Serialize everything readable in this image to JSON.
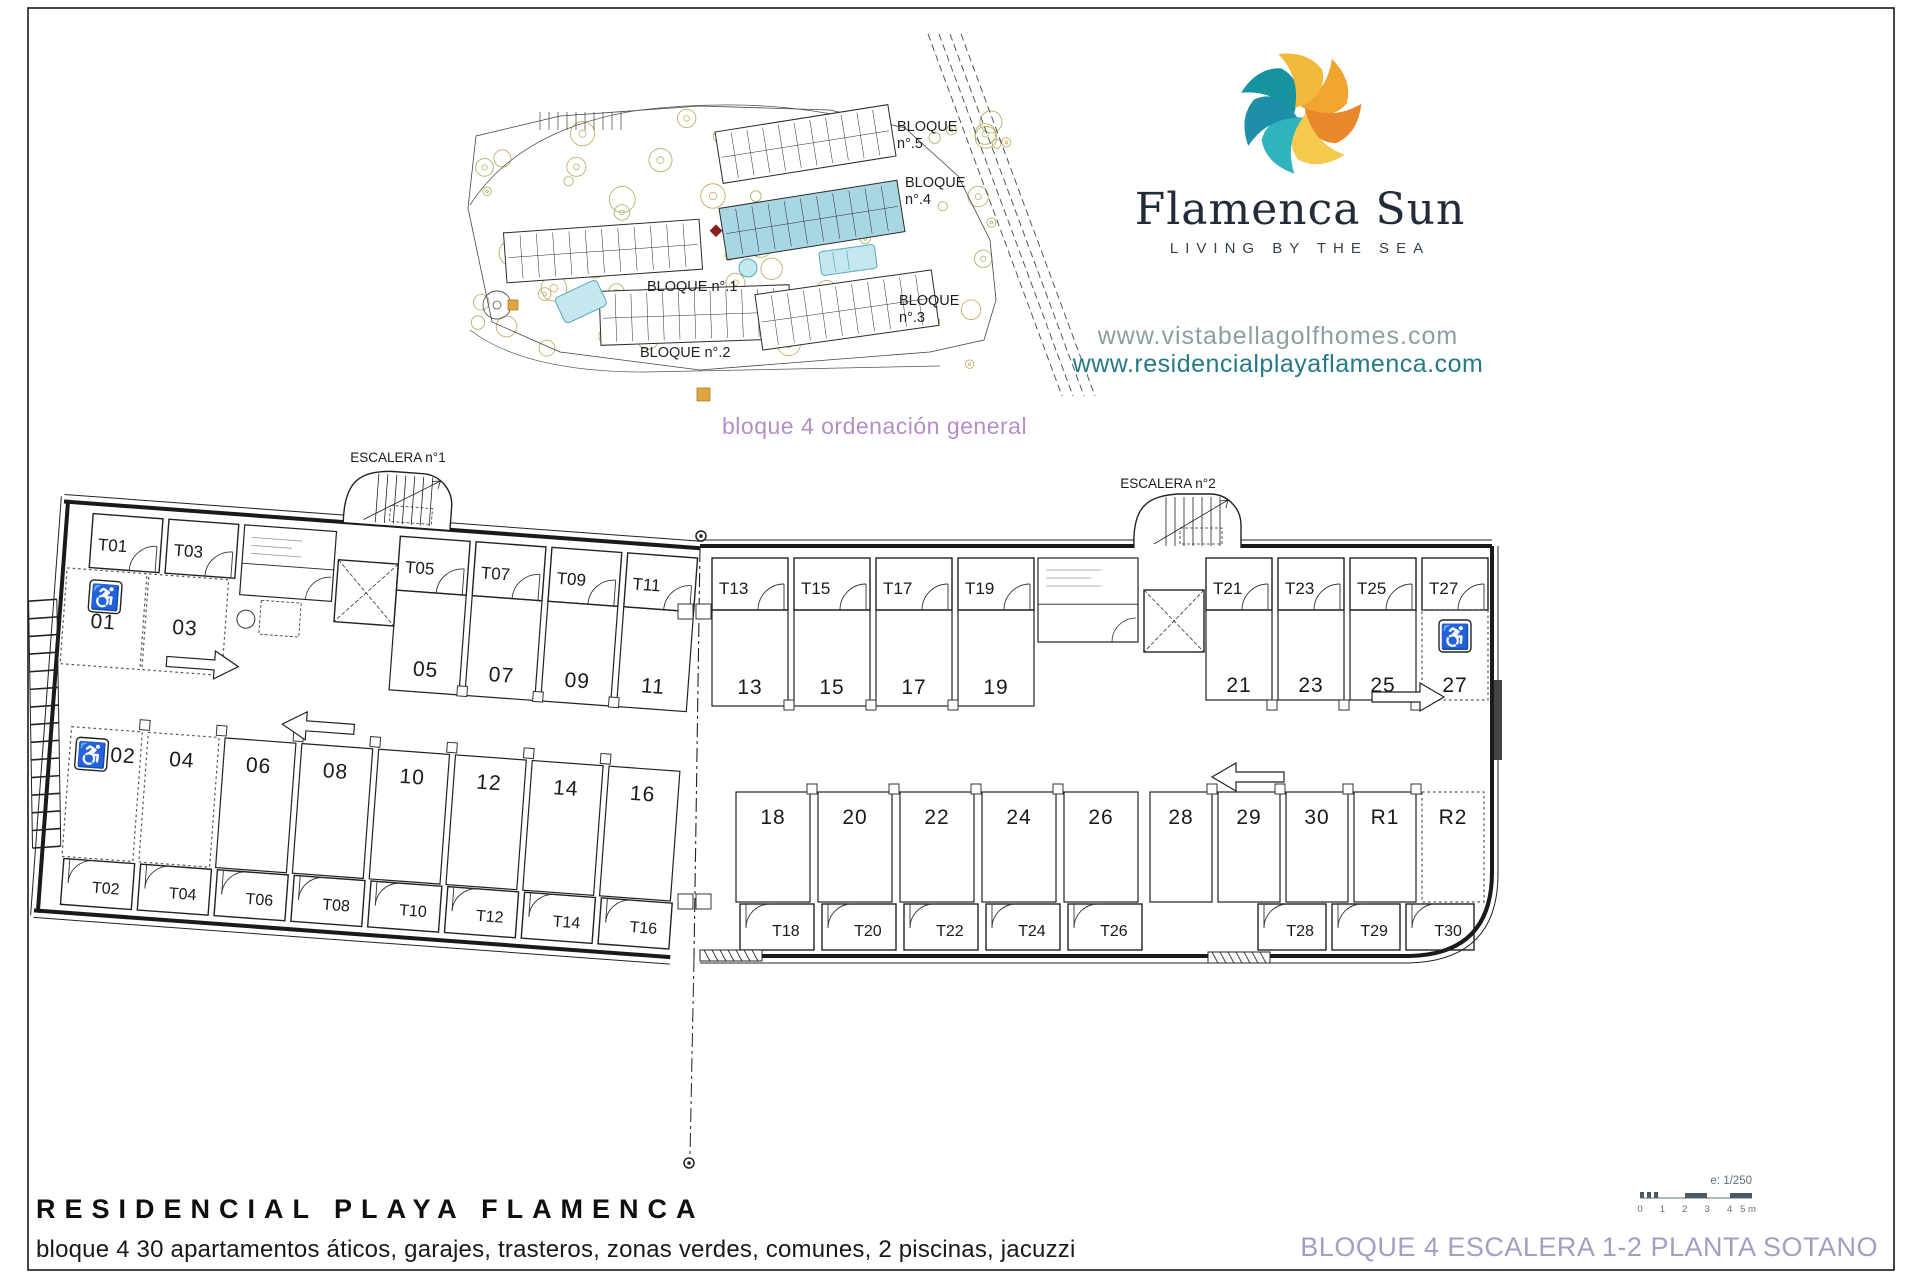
{
  "brand": {
    "name": "Flamenca Sun",
    "tagline": "LIVING BY THE SEA",
    "urls": {
      "primary": "www.vistabellagolfhomes.com",
      "secondary": "www.residencialplayaflamenca.com"
    },
    "logo_petal_colors": [
      "#f2a431",
      "#e8882b",
      "#f5c84e",
      "#2fb4bd",
      "#1f8fa8",
      "#17939f",
      "#f3b93c"
    ]
  },
  "site_plan": {
    "caption": "bloque 4 ordenación general",
    "highlight_color": "#a9d6e3",
    "blocks": [
      {
        "id": "bloque-5",
        "label_lines": [
          "BLOQUE",
          "n°.5"
        ]
      },
      {
        "id": "bloque-4",
        "label_lines": [
          "BLOQUE",
          "n°.4"
        ]
      },
      {
        "id": "bloque-1",
        "label_lines": [
          "BLOQUE n°.1"
        ]
      },
      {
        "id": "bloque-2",
        "label_lines": [
          "BLOQUE n°.2"
        ]
      },
      {
        "id": "bloque-3",
        "label_lines": [
          "BLOQUE",
          "n°.3"
        ]
      }
    ]
  },
  "floor_plan": {
    "stair1_label": "ESCALERA n°1",
    "stair2_label": "ESCALERA n°2",
    "left_wing": {
      "top_storage": [
        "T01",
        "T03",
        "T05",
        "T07",
        "T09",
        "T11"
      ],
      "top_parking": [
        "01",
        "03",
        "05",
        "07",
        "09",
        "11"
      ],
      "bottom_parking": [
        "02",
        "04",
        "06",
        "08",
        "10",
        "12",
        "14",
        "16"
      ],
      "bottom_storage": [
        "T02",
        "T04",
        "T06",
        "T08",
        "T10",
        "T12",
        "T14",
        "T16"
      ]
    },
    "right_wing": {
      "top_storage": [
        "T13",
        "T15",
        "T17",
        "T19",
        "T21",
        "T23",
        "T25",
        "T27"
      ],
      "top_parking": [
        "13",
        "15",
        "17",
        "19",
        "21",
        "23",
        "25",
        "27"
      ],
      "bottom_parking": [
        "18",
        "20",
        "22",
        "24",
        "26",
        "28",
        "29",
        "30",
        "R1",
        "R2"
      ],
      "bottom_storage": [
        "T18",
        "T20",
        "T22",
        "T24",
        "T26",
        "T28",
        "T29",
        "T30"
      ]
    },
    "dashed_stalls": [
      "01",
      "03",
      "02",
      "04",
      "27",
      "R2"
    ],
    "handicap_stalls": [
      "01",
      "02",
      "27"
    ],
    "scale": {
      "label": "e: 1/250",
      "ticks": [
        "0",
        "1",
        "2",
        "3",
        "4",
        "5 m"
      ]
    }
  },
  "footer": {
    "title": "RESIDENCIAL PLAYA FLAMENCA",
    "subtitle": "bloque 4 30 apartamentos áticos, garajes, trasteros, zonas verdes, comunes, 2 piscinas, jacuzzi",
    "sheet_title": "BLOQUE 4 ESCALERA 1-2 PLANTA SOTANO"
  }
}
